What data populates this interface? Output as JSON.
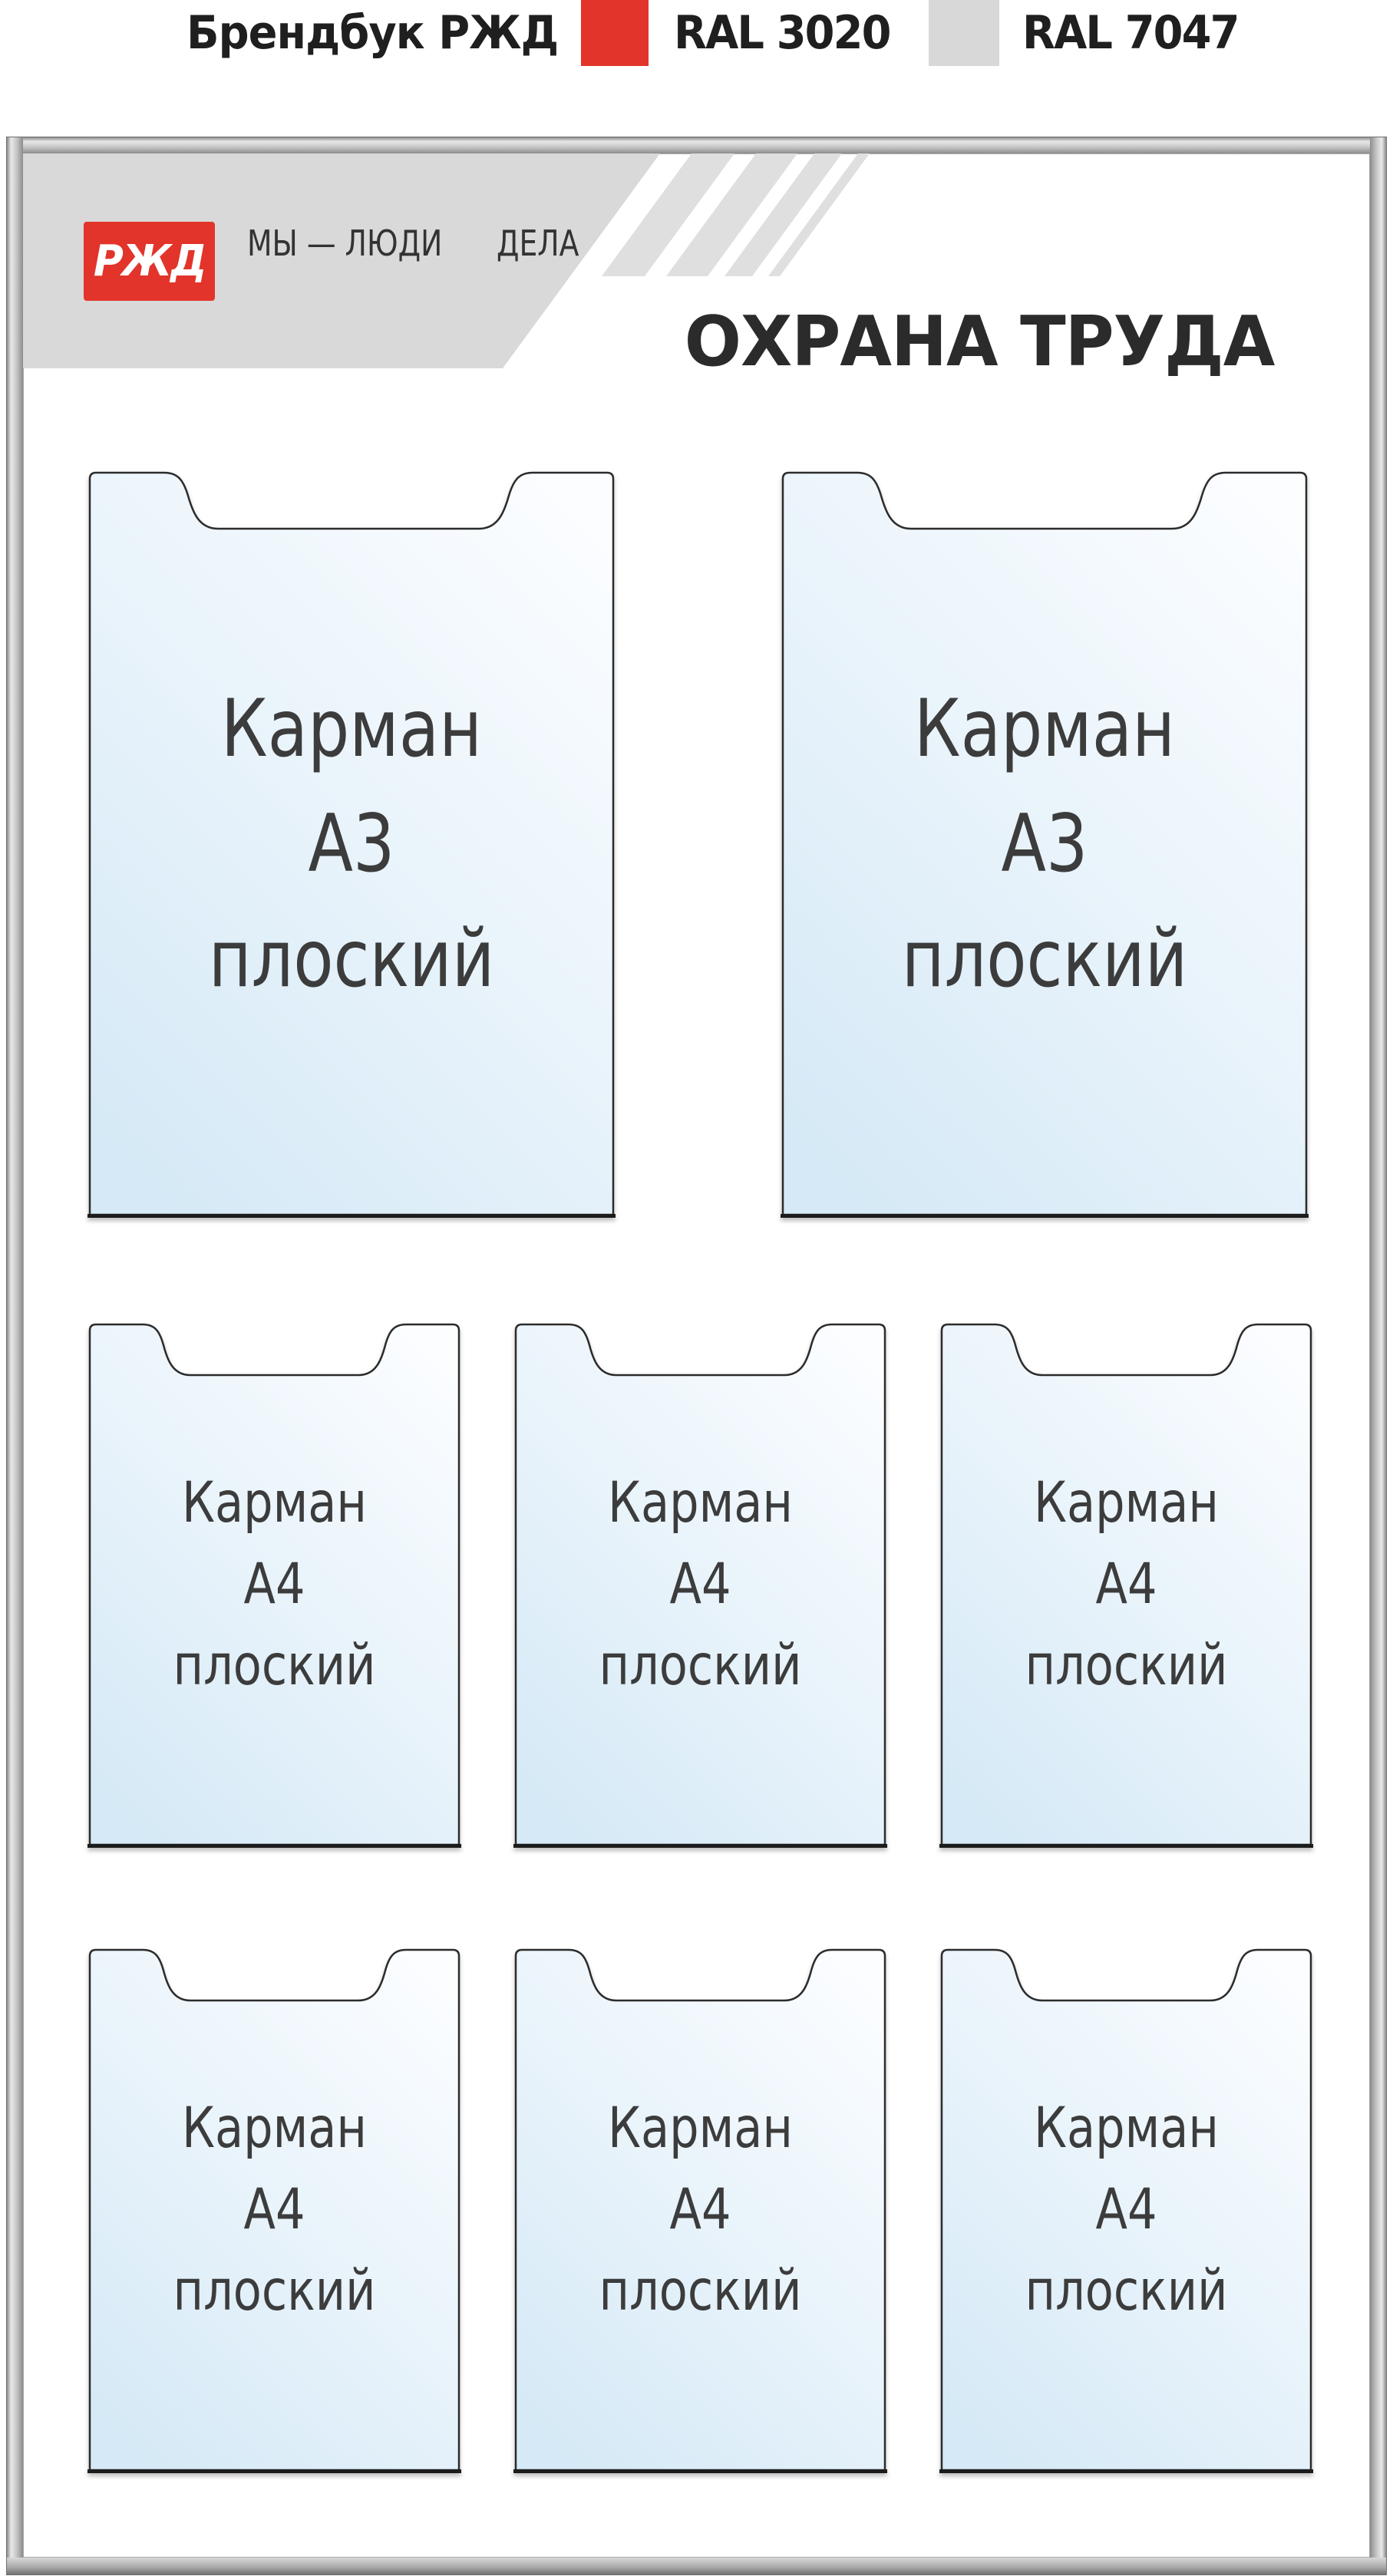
{
  "caption": {
    "brand": "Брендбук РЖД",
    "swatch1": {
      "label": "RAL 3020",
      "color": "#e2342a"
    },
    "swatch2": {
      "label": "RAL 7047",
      "color": "#d8d8d8"
    }
  },
  "board": {
    "header": {
      "logo_text": "РЖД",
      "logo_color": "#e2342a",
      "slogan_line1": "МЫ — ЛЮДИ",
      "slogan_line2": "ДЕЛА",
      "band_color": "#d8d9d8",
      "stripe_color": "#dedfde",
      "title": "ОХРАНА ТРУДА"
    },
    "pockets": {
      "a3_count": 2,
      "a4_count": 6,
      "a3": {
        "line1": "Карман",
        "line2": "А3",
        "line3": "плоский"
      },
      "a4": {
        "line1": "Карман",
        "line2": "А4",
        "line3": "плоский"
      }
    }
  }
}
